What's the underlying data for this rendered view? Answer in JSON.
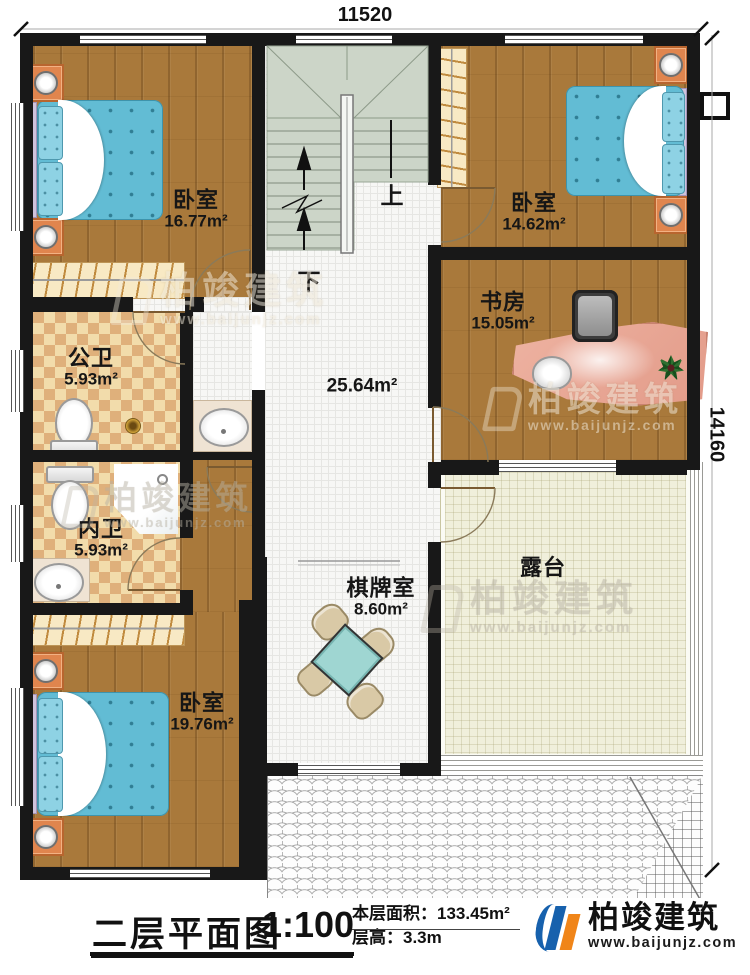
{
  "dimensions": {
    "top": "11520",
    "right": "14160"
  },
  "rooms": {
    "bedroom_tl": {
      "label": "卧室",
      "area": "16.77m²"
    },
    "bedroom_tr": {
      "label": "卧室",
      "area": "14.62m²"
    },
    "study": {
      "label": "书房",
      "area": "15.05m²"
    },
    "public_bath": {
      "label": "公卫",
      "area": "5.93m²"
    },
    "inner_bath": {
      "label": "内卫",
      "area": "5.93m²"
    },
    "bedroom_bl": {
      "label": "卧室",
      "area": "19.76m²"
    },
    "game_room": {
      "label": "棋牌室",
      "area": "8.60m²"
    },
    "terrace": {
      "label": "露台"
    },
    "hall": {
      "area": "25.64m²"
    }
  },
  "stairs": {
    "up_label": "上",
    "down_label": "下"
  },
  "title_block": {
    "title": "二层平面图",
    "scale": "1:100",
    "floor_area_label": "本层面积：",
    "floor_area_value": "133.45m²",
    "floor_height_label": "层高：",
    "floor_height_value": "3.3m"
  },
  "brand": {
    "name": "柏竣建筑",
    "website": "www.baijunjz.com"
  },
  "watermark": {
    "name": "柏竣建筑",
    "website": "www.baijunjz.com"
  },
  "colors": {
    "accent_blue": "#1761ad",
    "accent_orange": "#f08519",
    "wood": "#a9793b",
    "bed": "#62bcd4"
  }
}
